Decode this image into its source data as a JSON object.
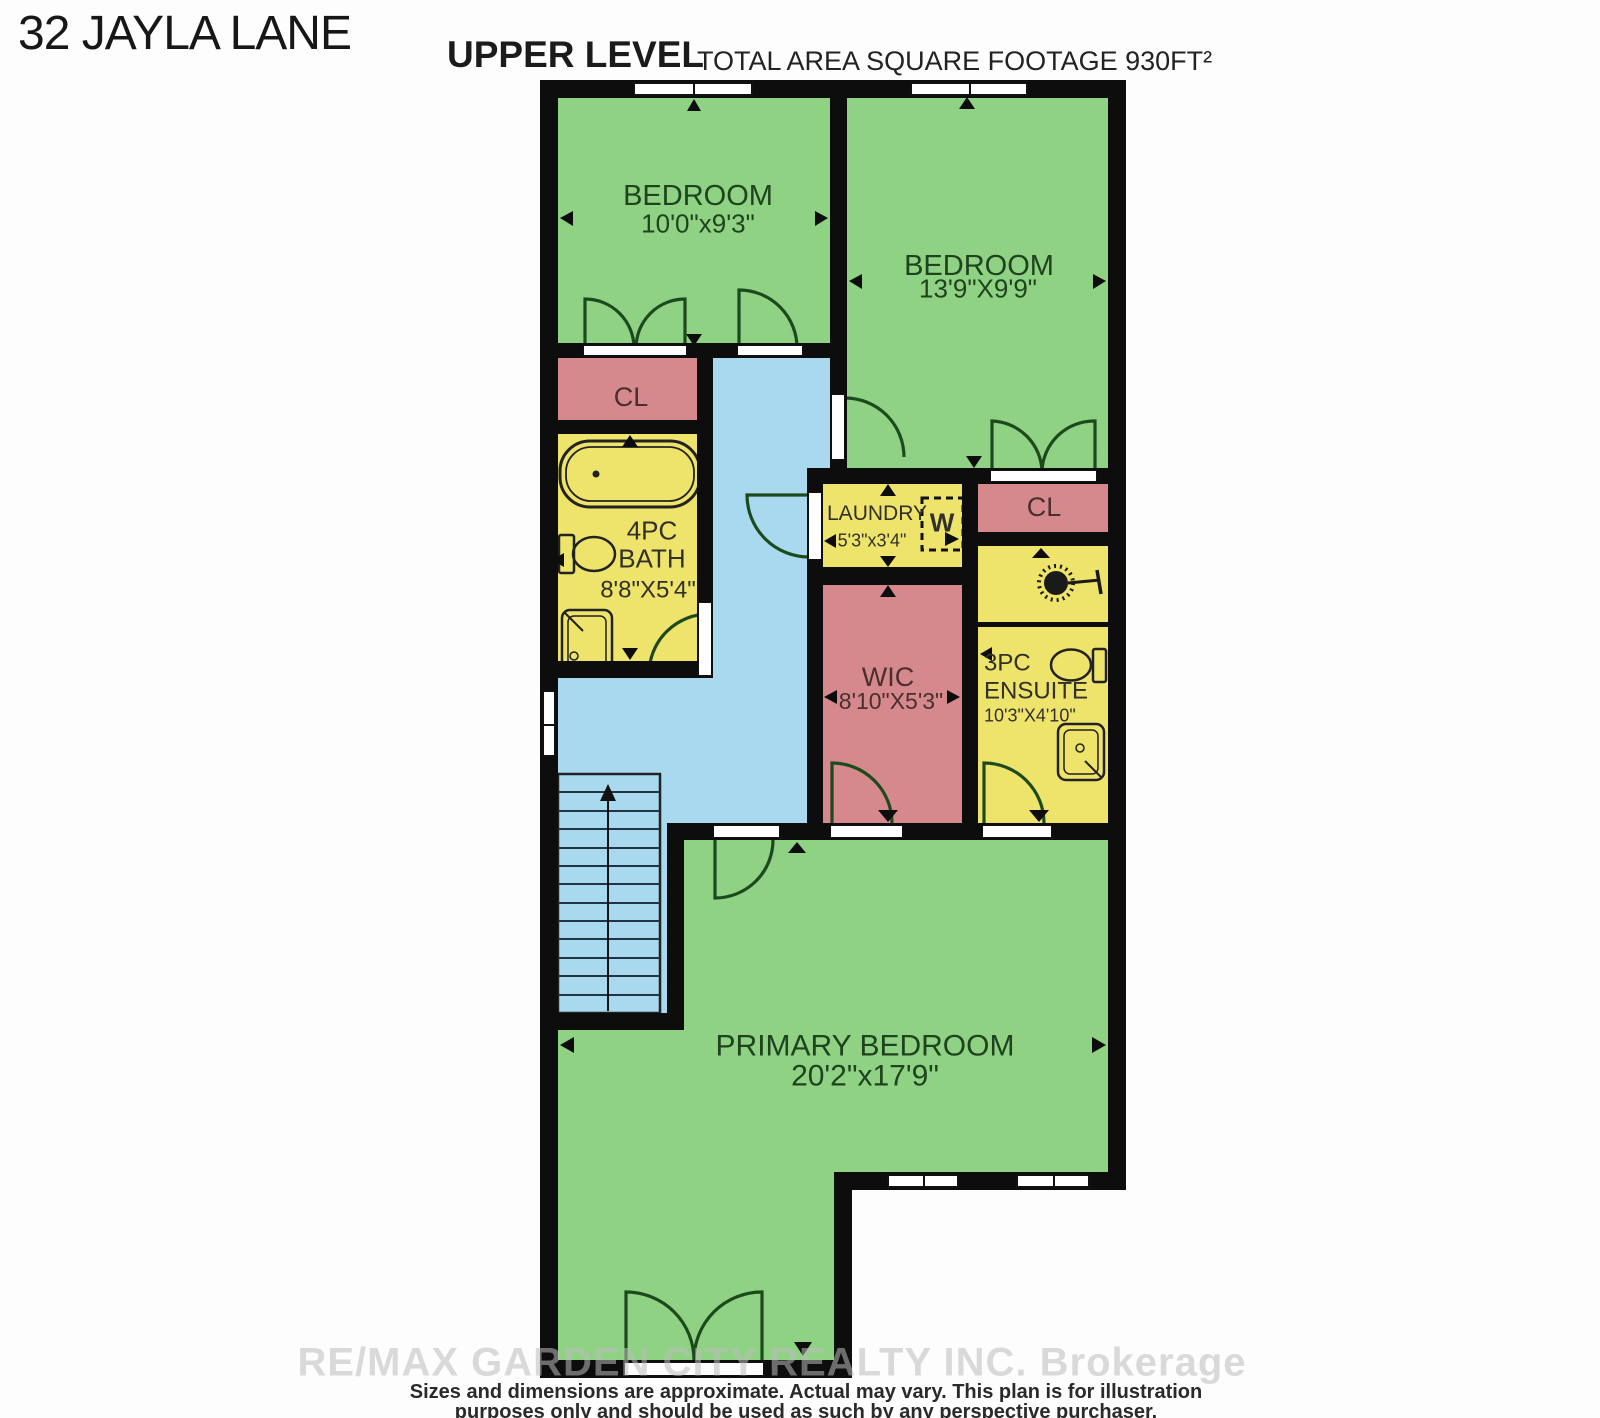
{
  "header": {
    "title": "32 JAYLA LANE",
    "level": "UPPER LEVEL",
    "area": "TOTAL AREA SQUARE FOOTAGE 930FT²"
  },
  "rooms": {
    "bedroom1": {
      "name": "BEDROOM",
      "dims": "10'0\"x9'3\""
    },
    "bedroom2": {
      "name": "BEDROOM",
      "dims": "13'9\"X9'9\""
    },
    "closet1": {
      "name": "CL"
    },
    "closet2": {
      "name": "CL"
    },
    "bath": {
      "line1": "4PC",
      "line2": "BATH",
      "dims": "8'8\"X5'4\""
    },
    "laundry": {
      "name": "LAUNDRY",
      "dims": "5'3\"x3'4\"",
      "washer": "W"
    },
    "wic": {
      "name": "WIC",
      "dims": "8'10\"X5'3\""
    },
    "ensuite": {
      "line1": "3PC",
      "line2": "ENSUITE",
      "dims": "10'3\"X4'10\""
    },
    "primary": {
      "name": "PRIMARY BEDROOM",
      "dims": "20'2\"x17'9\""
    }
  },
  "footer": {
    "line1": "Sizes and dimensions are approximate. Actual may vary. This plan is for illustration",
    "line2": "purposes only and should be used as such by any perspective purchaser.",
    "watermark": "RE/MAX GARDEN CITY REALTY INC. Brokerage"
  },
  "colors": {
    "room_green": "#90d284",
    "hall_blue": "#a9d9ef",
    "closet_pink": "#d5898c",
    "wet_yellow": "#eee46c",
    "wall_black": "#0d0d0d",
    "door_green": "#1d4a1d"
  }
}
